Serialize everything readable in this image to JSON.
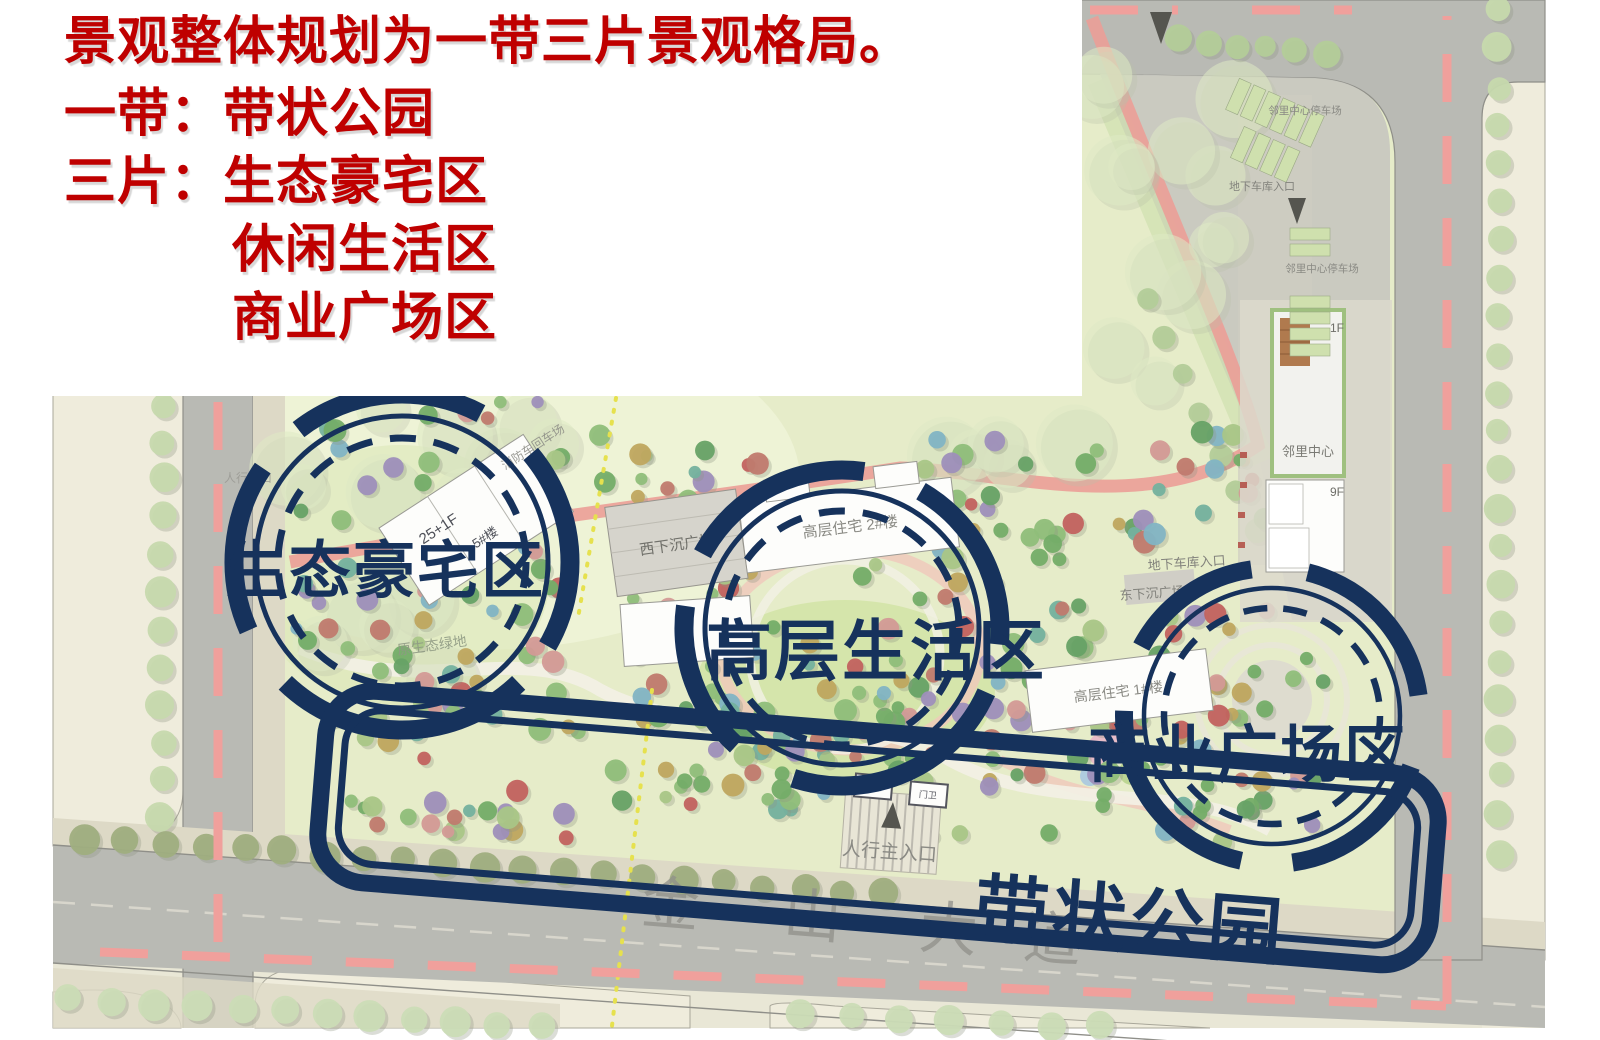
{
  "title_block": {
    "text_color": "#bf0000",
    "line1": "景观整体规划为一带三片景观格局。",
    "line2": "一带：带状公园",
    "line3": "三片：生态豪宅区",
    "line4": "休闲生活区",
    "line5": "商业广场区"
  },
  "annotations": {
    "color": "#16325c",
    "zone_left": "生态豪宅区",
    "zone_middle": "高层生活区",
    "zone_right": "商业广场区",
    "belt": "带状公园"
  },
  "map_labels": {
    "road_name_chars": [
      "金",
      "山",
      "大",
      "道"
    ],
    "west_sunken_plaza": "西下沉广场",
    "east_sunken_plaza": "东下沉广场",
    "garage_entrance_east": "地下车库入口",
    "garage_entrance_north": "地下车库入口",
    "neighborhood_center": "邻里中心",
    "neighborhood_center_parking": "邻里中心停车场",
    "building_left_floors": "25+1F",
    "building_left_number": "5#楼",
    "building_mid": "高层住宅 2#楼",
    "building_right": "高层住宅 1#楼",
    "fire_lane": "消防车回车场",
    "eco_green": "原生态绿地",
    "guard_1": "门卫",
    "guard_2": "门卫",
    "main_ped_entrance": "人行主入口",
    "ped_entrance": "人行入口",
    "floor_1f": "1F",
    "floor_9f": "9F"
  }
}
